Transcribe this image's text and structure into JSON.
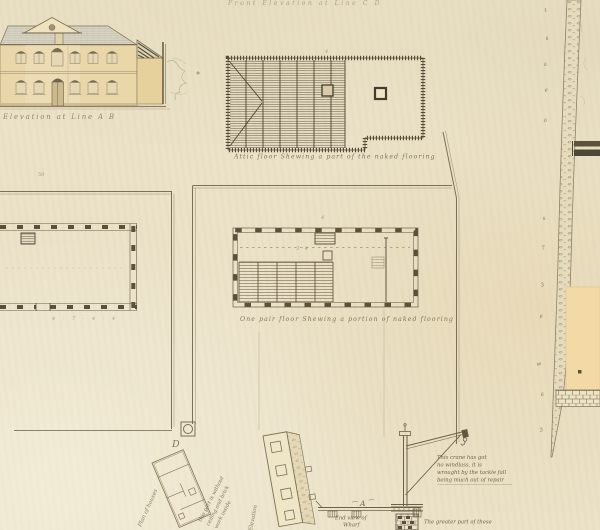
{
  "sheet": {
    "description": "Scanned hand-drawn architectural survey sheet",
    "paper_color": "#ebe2c8",
    "ink_color": "#5f5640"
  },
  "captions": {
    "top_fragment": "Front Elevation at Line C D",
    "left_elevation": "Elevation at Line A B",
    "attic_plan": "Attic floor Shewing a part of the naked flooring",
    "one_pair_plan": "One pair floor Shewing a portion of naked flooring",
    "tilted_plan": "Plan of houses",
    "tilted_elevation": "Elevation",
    "end_view_line1": "End view of",
    "end_view_line2": "Wharf",
    "greater_part": "The greater part of these",
    "corner_letter": "D",
    "wharf_letter": "A"
  },
  "crane_note": {
    "lines": [
      "This crane has got",
      "no windlass, it is",
      "wrought by the tackle fall",
      "being much out of repair"
    ]
  },
  "tilted_note": {
    "lines": [
      "this part is without",
      "ceiling and brick",
      "work inside"
    ]
  },
  "margin_marks": [
    "t",
    "s",
    "a",
    "e",
    "o",
    "s",
    "7",
    "3",
    "e",
    "w",
    "a",
    "3"
  ],
  "dim_marks": [
    "50",
    "4 · 7 · 4 · 4",
    "3 4",
    "4",
    "4"
  ],
  "colors": {
    "wall_wash": "#ead7a9",
    "annex_wash": "#e6d09c",
    "roof_wash": "#d8d4c4",
    "window_head": "#776b52",
    "peach_block": "#f3d9a6"
  }
}
